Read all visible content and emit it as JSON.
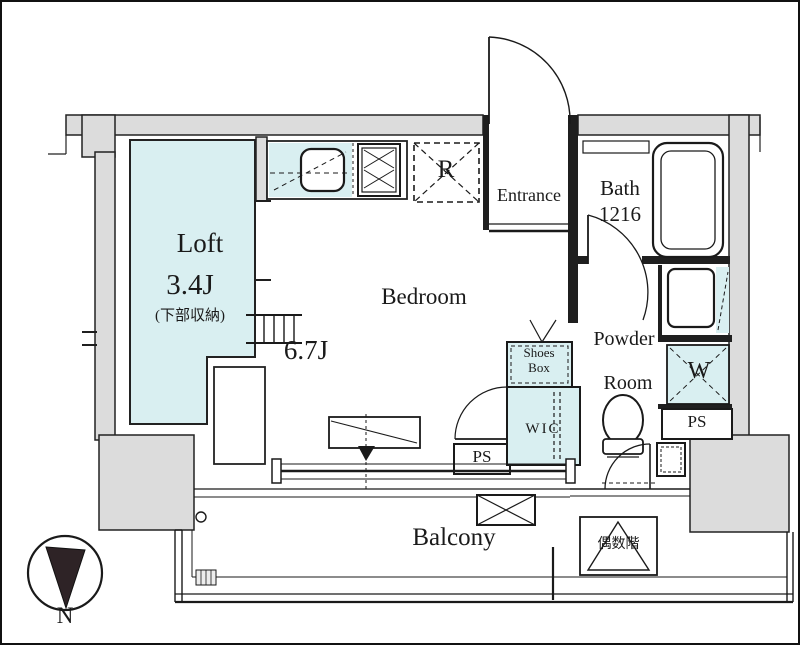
{
  "plan_title": "studio-apartment-floor-plan",
  "colors": {
    "room_highlight": "#d9eff1",
    "wall_fill": "#dcdcdc",
    "line": "#1a1a1a"
  },
  "rooms": {
    "loft": {
      "label": "Loft",
      "size": "3.4J",
      "note": "(下部収納)"
    },
    "bedroom": {
      "label": "Bedroom",
      "size": "6.7J"
    },
    "entrance": {
      "label": "Entrance"
    },
    "bath": {
      "label": "Bath",
      "size": "1216"
    },
    "powder_room": {
      "line1": "Powder",
      "line2": "Room"
    },
    "wic": {
      "label": "WIC"
    },
    "shoes_box": {
      "line1": "Shoes",
      "line2": "Box"
    },
    "balcony": {
      "label": "Balcony"
    }
  },
  "fixtures": {
    "refrigerator": {
      "label": "R"
    },
    "washer": {
      "label": "W"
    },
    "pipe_shaft_1": {
      "label": "PS"
    },
    "pipe_shaft_2": {
      "label": "PS"
    },
    "evacuation_hatch": {
      "label": "偶数階"
    }
  },
  "compass": {
    "label": "N"
  }
}
